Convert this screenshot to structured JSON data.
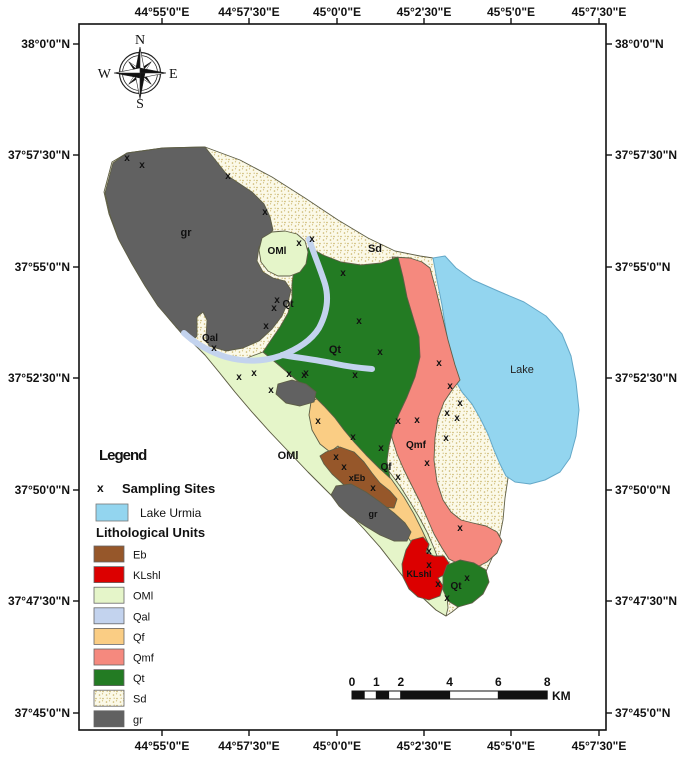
{
  "axes": {
    "top_labels": [
      "44°55'0\"E",
      "44°57'30\"E",
      "45°0'0\"E",
      "45°2'30\"E",
      "45°5'0\"E",
      "45°7'30\"E"
    ],
    "bottom_labels": [
      "44°55'0\"E",
      "44°57'30\"E",
      "45°0'0\"E",
      "45°2'30\"E",
      "45°5'0\"E",
      "45°7'30\"E"
    ],
    "left_labels": [
      "38°0'0\"N",
      "37°57'30\"N",
      "37°55'0\"N",
      "37°52'30\"N",
      "37°50'0\"N",
      "37°47'30\"N",
      "37°45'0\"N"
    ],
    "right_labels": [
      "38°0'0\"N",
      "37°57'30\"N",
      "37°55'0\"N",
      "37°52'30\"N",
      "37°50'0\"N",
      "37°47'30\"N",
      "37°45'0\"N"
    ],
    "lon_px": [
      162,
      249,
      337,
      424,
      511,
      599
    ],
    "lat_px": [
      44,
      155,
      267,
      378,
      490,
      601,
      713
    ]
  },
  "compass": {
    "north": "N",
    "east": "E",
    "south": "S",
    "west": "W"
  },
  "legend": {
    "title": "Legend",
    "sampling_symbol": "x",
    "sampling_label": "Sampling Sites",
    "lake_label": "Lake Urmia",
    "litho_header": "Lithological Units",
    "items": [
      {
        "code": "Eb",
        "color": "#96572A"
      },
      {
        "code": "KLshl",
        "color": "#DC0000"
      },
      {
        "code": "OMl",
        "color": "#E5F5C9"
      },
      {
        "code": "Qal",
        "color": "#C3D3EE"
      },
      {
        "code": "Qf",
        "color": "#FACD84"
      },
      {
        "code": "Qmf",
        "color": "#F5897E"
      },
      {
        "code": "Qt",
        "color": "#237B23"
      },
      {
        "code": "Sd",
        "color": "#FBF9E8",
        "pattern": "dots"
      },
      {
        "code": "gr",
        "color": "#616161"
      }
    ]
  },
  "map": {
    "colors": {
      "lake": "#93D5EF",
      "lake_border": "#64A8C8",
      "river": "#C3D3EE",
      "sd_dot": "#C9B469",
      "region_border": "#5E5E46"
    },
    "unit_labels": [
      {
        "text": "gr",
        "x": 186,
        "y": 236,
        "size": 11
      },
      {
        "text": "OMl",
        "x": 277,
        "y": 254,
        "size": 10
      },
      {
        "text": "Sd",
        "x": 375,
        "y": 252,
        "size": 11
      },
      {
        "text": "Qt",
        "x": 288,
        "y": 307,
        "size": 10
      },
      {
        "text": "Qal",
        "x": 210,
        "y": 341,
        "size": 10
      },
      {
        "text": "Qt",
        "x": 335,
        "y": 353,
        "size": 11
      },
      {
        "text": "OMl",
        "x": 288,
        "y": 459,
        "size": 11
      },
      {
        "text": "Qmf",
        "x": 416,
        "y": 448,
        "size": 10
      },
      {
        "text": "Qf",
        "x": 386,
        "y": 470,
        "size": 10
      },
      {
        "text": "xEb",
        "x": 357,
        "y": 481,
        "size": 9
      },
      {
        "text": "gr",
        "x": 373,
        "y": 517,
        "size": 9
      },
      {
        "text": "KLshl",
        "x": 419,
        "y": 577,
        "size": 9,
        "color": "#420000"
      },
      {
        "text": "Qt",
        "x": 456,
        "y": 589,
        "size": 10
      },
      {
        "text": "Lake",
        "x": 522,
        "y": 373,
        "size": 11
      }
    ],
    "sampling_sites": [
      [
        127,
        158
      ],
      [
        142,
        165
      ],
      [
        228,
        176
      ],
      [
        265,
        212
      ],
      [
        299,
        243
      ],
      [
        312,
        239
      ],
      [
        343,
        273
      ],
      [
        359,
        321
      ],
      [
        304,
        375
      ],
      [
        380,
        352
      ],
      [
        277,
        300
      ],
      [
        274,
        308
      ],
      [
        266,
        326
      ],
      [
        214,
        348
      ],
      [
        239,
        377
      ],
      [
        254,
        373
      ],
      [
        271,
        390
      ],
      [
        289,
        374
      ],
      [
        306,
        373
      ],
      [
        355,
        375
      ],
      [
        318,
        421
      ],
      [
        353,
        437
      ],
      [
        381,
        448
      ],
      [
        398,
        421
      ],
      [
        417,
        420
      ],
      [
        439,
        363
      ],
      [
        450,
        386
      ],
      [
        460,
        403
      ],
      [
        447,
        413
      ],
      [
        457,
        418
      ],
      [
        446,
        438
      ],
      [
        427,
        463
      ],
      [
        460,
        528
      ],
      [
        336,
        457
      ],
      [
        344,
        467
      ],
      [
        373,
        488
      ],
      [
        398,
        477
      ],
      [
        429,
        551
      ],
      [
        429,
        565
      ],
      [
        438,
        584
      ],
      [
        447,
        598
      ],
      [
        467,
        578
      ]
    ]
  },
  "scalebar": {
    "tick_labels": [
      "0",
      "1",
      "2",
      "4",
      "6",
      "8"
    ],
    "tick_km": [
      0,
      1,
      2,
      4,
      6,
      8
    ],
    "segments_km": [
      [
        0,
        0.5
      ],
      [
        0.5,
        1
      ],
      [
        1,
        1.5
      ],
      [
        1.5,
        2
      ],
      [
        2,
        4
      ],
      [
        4,
        6
      ],
      [
        6,
        8
      ]
    ],
    "unit": "KM"
  }
}
